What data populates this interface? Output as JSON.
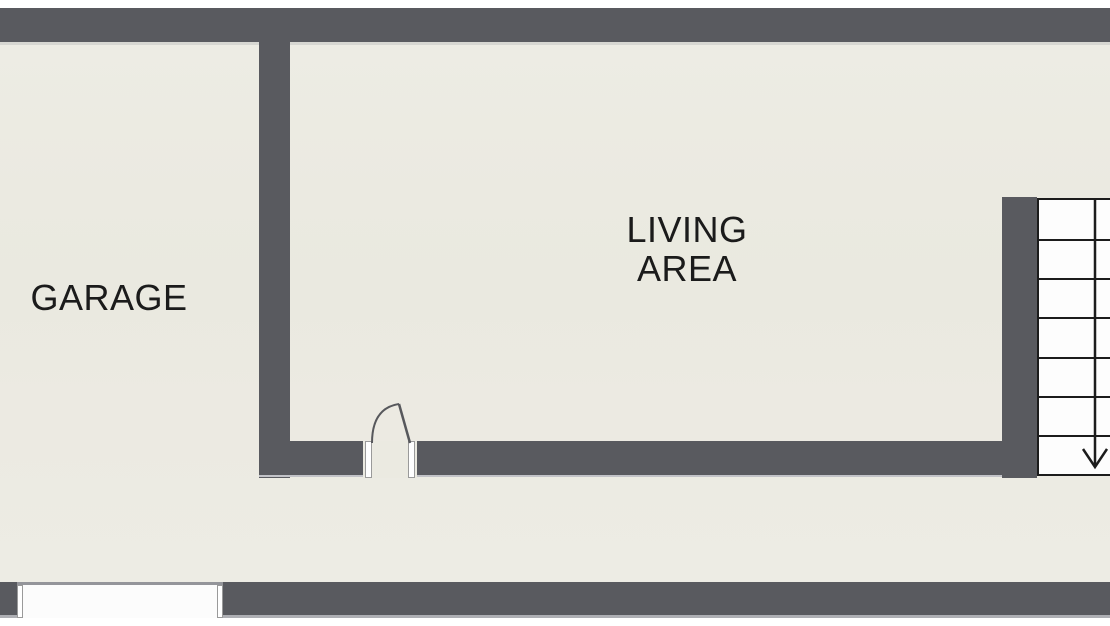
{
  "rooms": {
    "garage": {
      "label": "GARAGE"
    },
    "living_area": {
      "label_lines": [
        "LIVING",
        "AREA"
      ]
    }
  },
  "stairs": {
    "step_count": 7,
    "direction": "down"
  },
  "doors": {
    "interior_door": {
      "type": "swing-door"
    },
    "garage_door": {
      "type": "wall-opening"
    }
  },
  "colors": {
    "wall": "#595a5f",
    "floor": "#ebeae2",
    "stair_fill": "#fdfdfd",
    "outline": "#1c1c1c",
    "text": "#1b1b1b",
    "page_background": "#ffffff"
  }
}
